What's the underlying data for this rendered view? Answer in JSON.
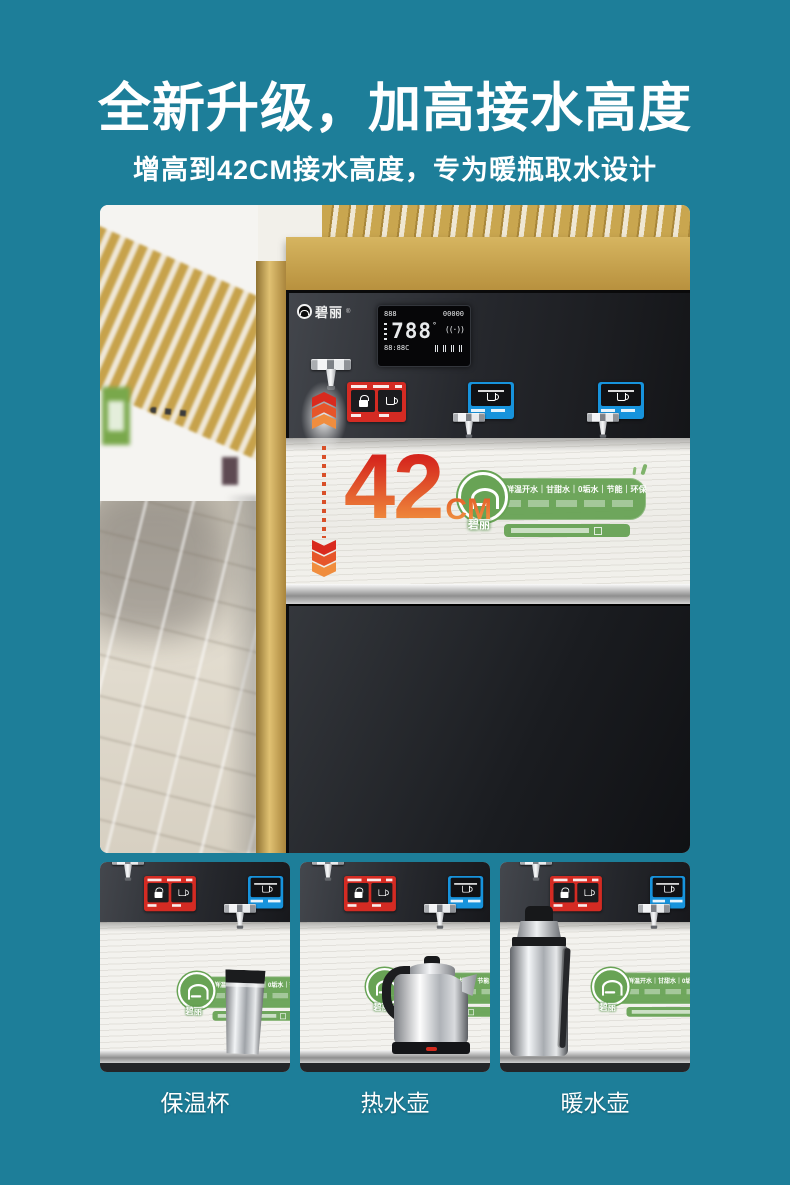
{
  "page": {
    "background_color": "#1d7e99"
  },
  "header": {
    "title": "全新升级，加高接水高度",
    "subtitle": "增高到42CM接水高度，专为暖瓶取水设计"
  },
  "hero": {
    "brand": "碧丽",
    "brand_reg": "®",
    "display": {
      "top_left": "888",
      "top_right": "00000",
      "main": "788",
      "degree": "°",
      "signal": "((·))",
      "bottom": "88:88C"
    },
    "measurement": {
      "value": "42",
      "unit": "CM"
    },
    "badge": {
      "brand": "碧丽",
      "slogan": "新鲜温开水｜甘甜水｜0垢水｜节能｜环保"
    }
  },
  "colors": {
    "background": "#1d7e99",
    "accent_red": "#d42b23",
    "accent_blue": "#1793dc",
    "badge_green": "#68a355",
    "gradient_42_top": "#d5261d",
    "gradient_42_bottom": "#ef8a3c",
    "gold_frame": "#c5a353"
  },
  "thumbnails": [
    {
      "label": "保温杯"
    },
    {
      "label": "热水壶"
    },
    {
      "label": "暖水壶"
    }
  ]
}
